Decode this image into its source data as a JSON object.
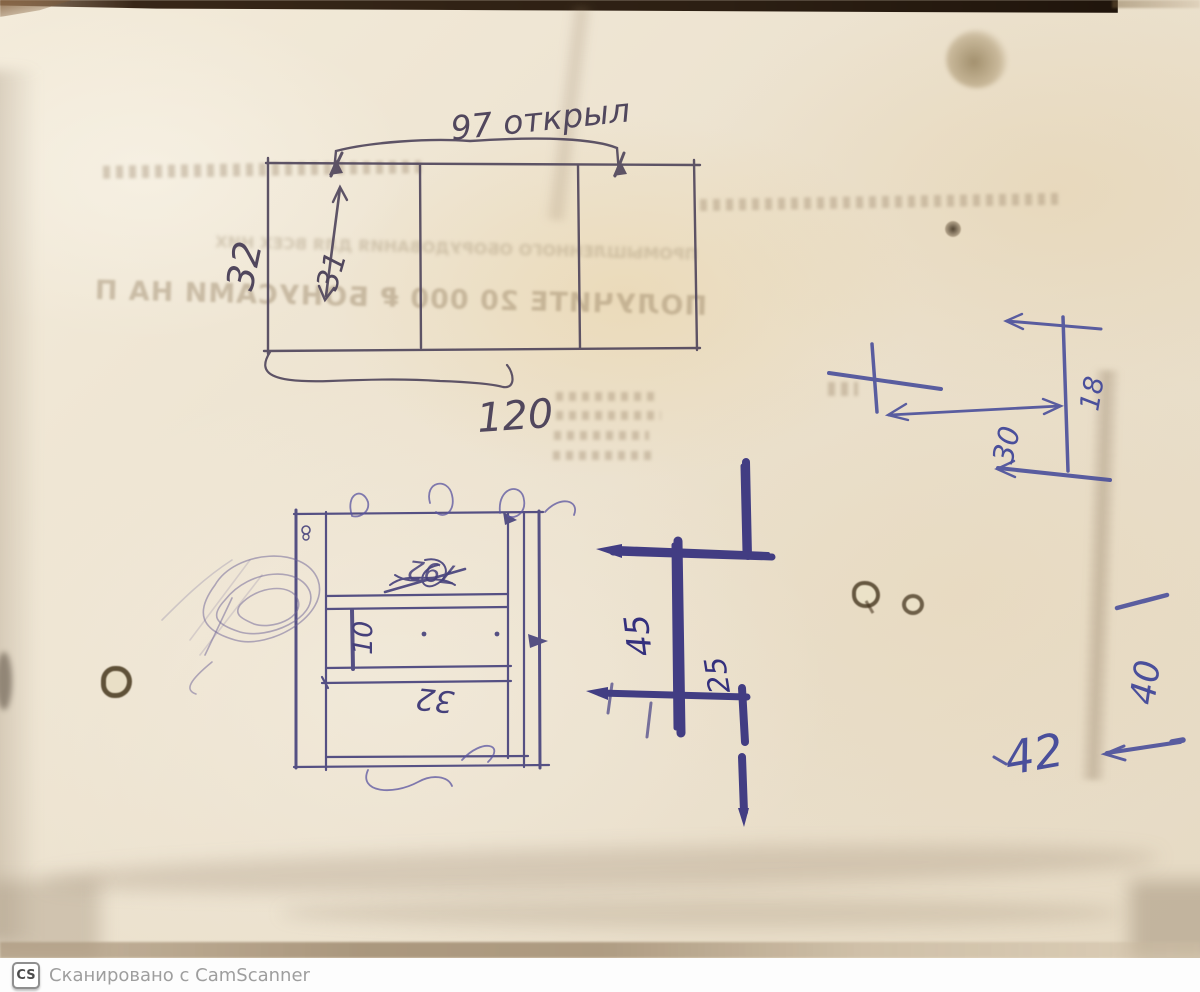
{
  "colors": {
    "pencil_ink": "#51475d",
    "light_blue_ink": "#45407b",
    "heavy_blue_ink": "#34307d",
    "blue_pen": "#4a4f9b",
    "paper": "#ece2cf"
  },
  "top_drawing": {
    "width_label": "97 открыл",
    "height_outer": "32",
    "height_inner": "31",
    "total_width": "120"
  },
  "cabinet_drawing": {
    "scribbled_value": "792",
    "shelf_depth": "10",
    "inner_width": "32"
  },
  "profile_sketch": {
    "dim_left": "45",
    "dim_right": "25"
  },
  "corner_detail": {
    "offset": "30",
    "height": "18"
  },
  "edge_dims": {
    "vertical": "40",
    "value": "42"
  },
  "ghost_text": {
    "promo_line": "ПОЛУЧИТЕ 20 000 ₽ БОНУСАМИ НА ПОКУПКУ",
    "sub_line": "ПРОМЫШЛЕННОГО ОБОРУДОВАНИЯ ДЛЯ ВСЕХ НИХ"
  },
  "watermark": {
    "logo": "CS",
    "text": "Сканировано с CamScanner"
  }
}
